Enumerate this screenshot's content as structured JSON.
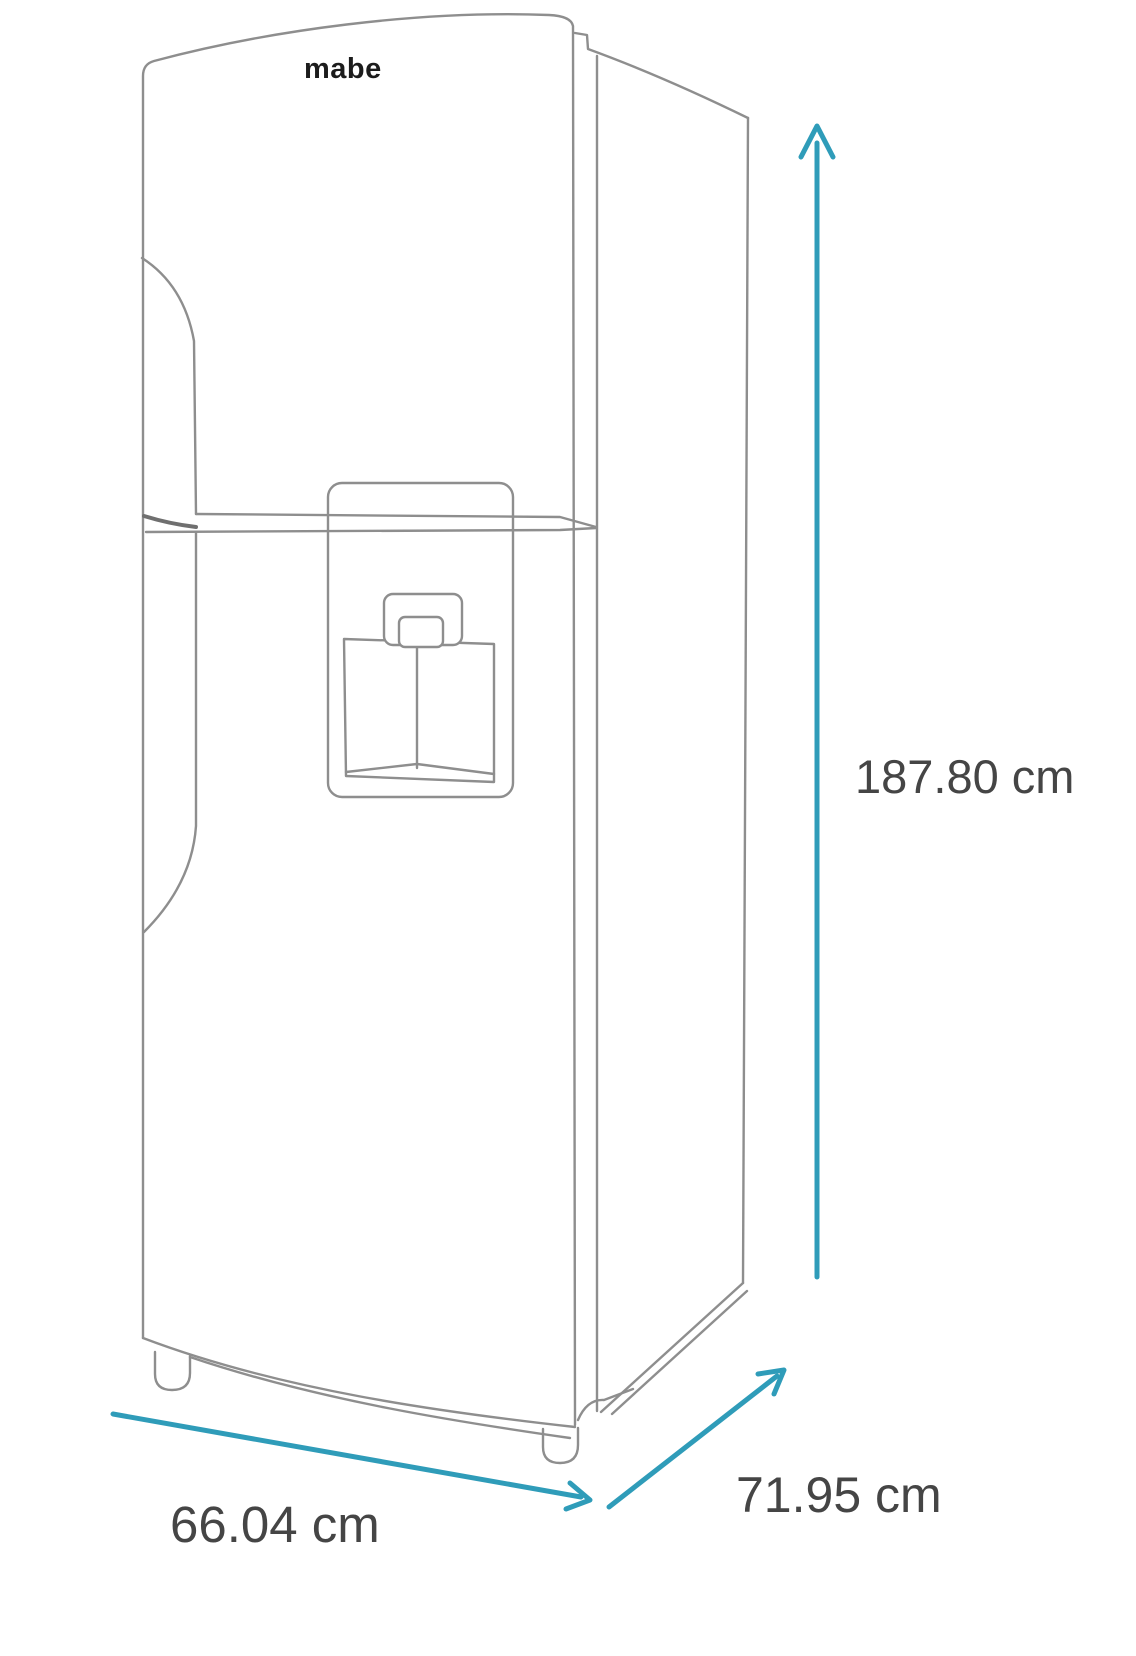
{
  "diagram": {
    "type": "product-dimension-diagram",
    "product": "top-freezer refrigerator with water dispenser (isometric line drawing)",
    "brand_logo": "mabe",
    "dimensions": {
      "height": "187.80 cm",
      "width": "66.04 cm",
      "depth": "71.95 cm"
    },
    "colors": {
      "arrow": "#2f9cb9",
      "outline": "#8e8e8e",
      "outline_dark": "#6f6f6f",
      "text": "#454545",
      "logo": "#1c1c1c",
      "background": "#ffffff"
    }
  }
}
